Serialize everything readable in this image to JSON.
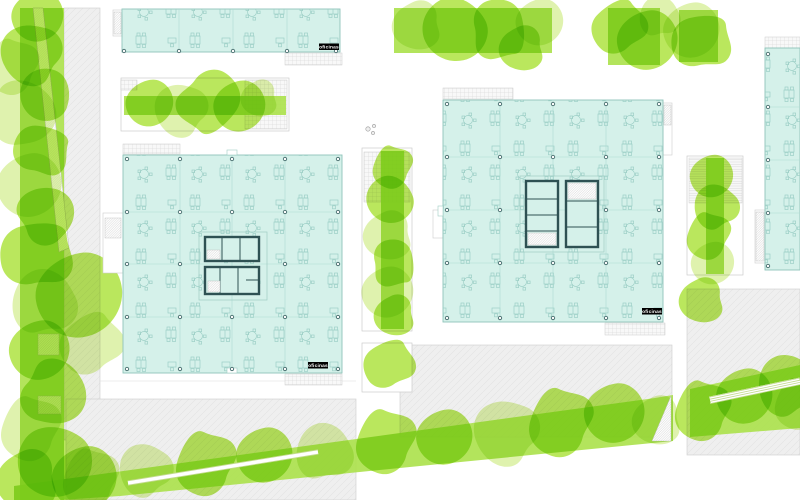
{
  "plan": {
    "type": "architectural-site-plan",
    "description": "office campus ground plan with furniture layouts and landscaped bands"
  },
  "labels": {
    "offices": "oficinas"
  },
  "buildings": [
    {
      "id": "north-bar",
      "label": "oficinas"
    },
    {
      "id": "west-block",
      "label": "oficinas"
    },
    {
      "id": "east-block",
      "label": "oficinas"
    },
    {
      "id": "east-edge-bar",
      "label": ""
    }
  ],
  "colors": {
    "floor": "#d5f1ea",
    "floor-border": "#8fc4ba",
    "furniture": "#9ccfc6",
    "partition": "#aedbd2",
    "core": "#2e5153",
    "dot": "#456d6d",
    "green-bright": "#a6e02f",
    "green-light": "#d9f0a0",
    "green-mid": "#abe14a",
    "plaza": "#efefef",
    "plaza-border": "#cccccc",
    "hatch": "#d6d6d6",
    "label-bg": "#000000",
    "label-fg": "#ffffff"
  }
}
